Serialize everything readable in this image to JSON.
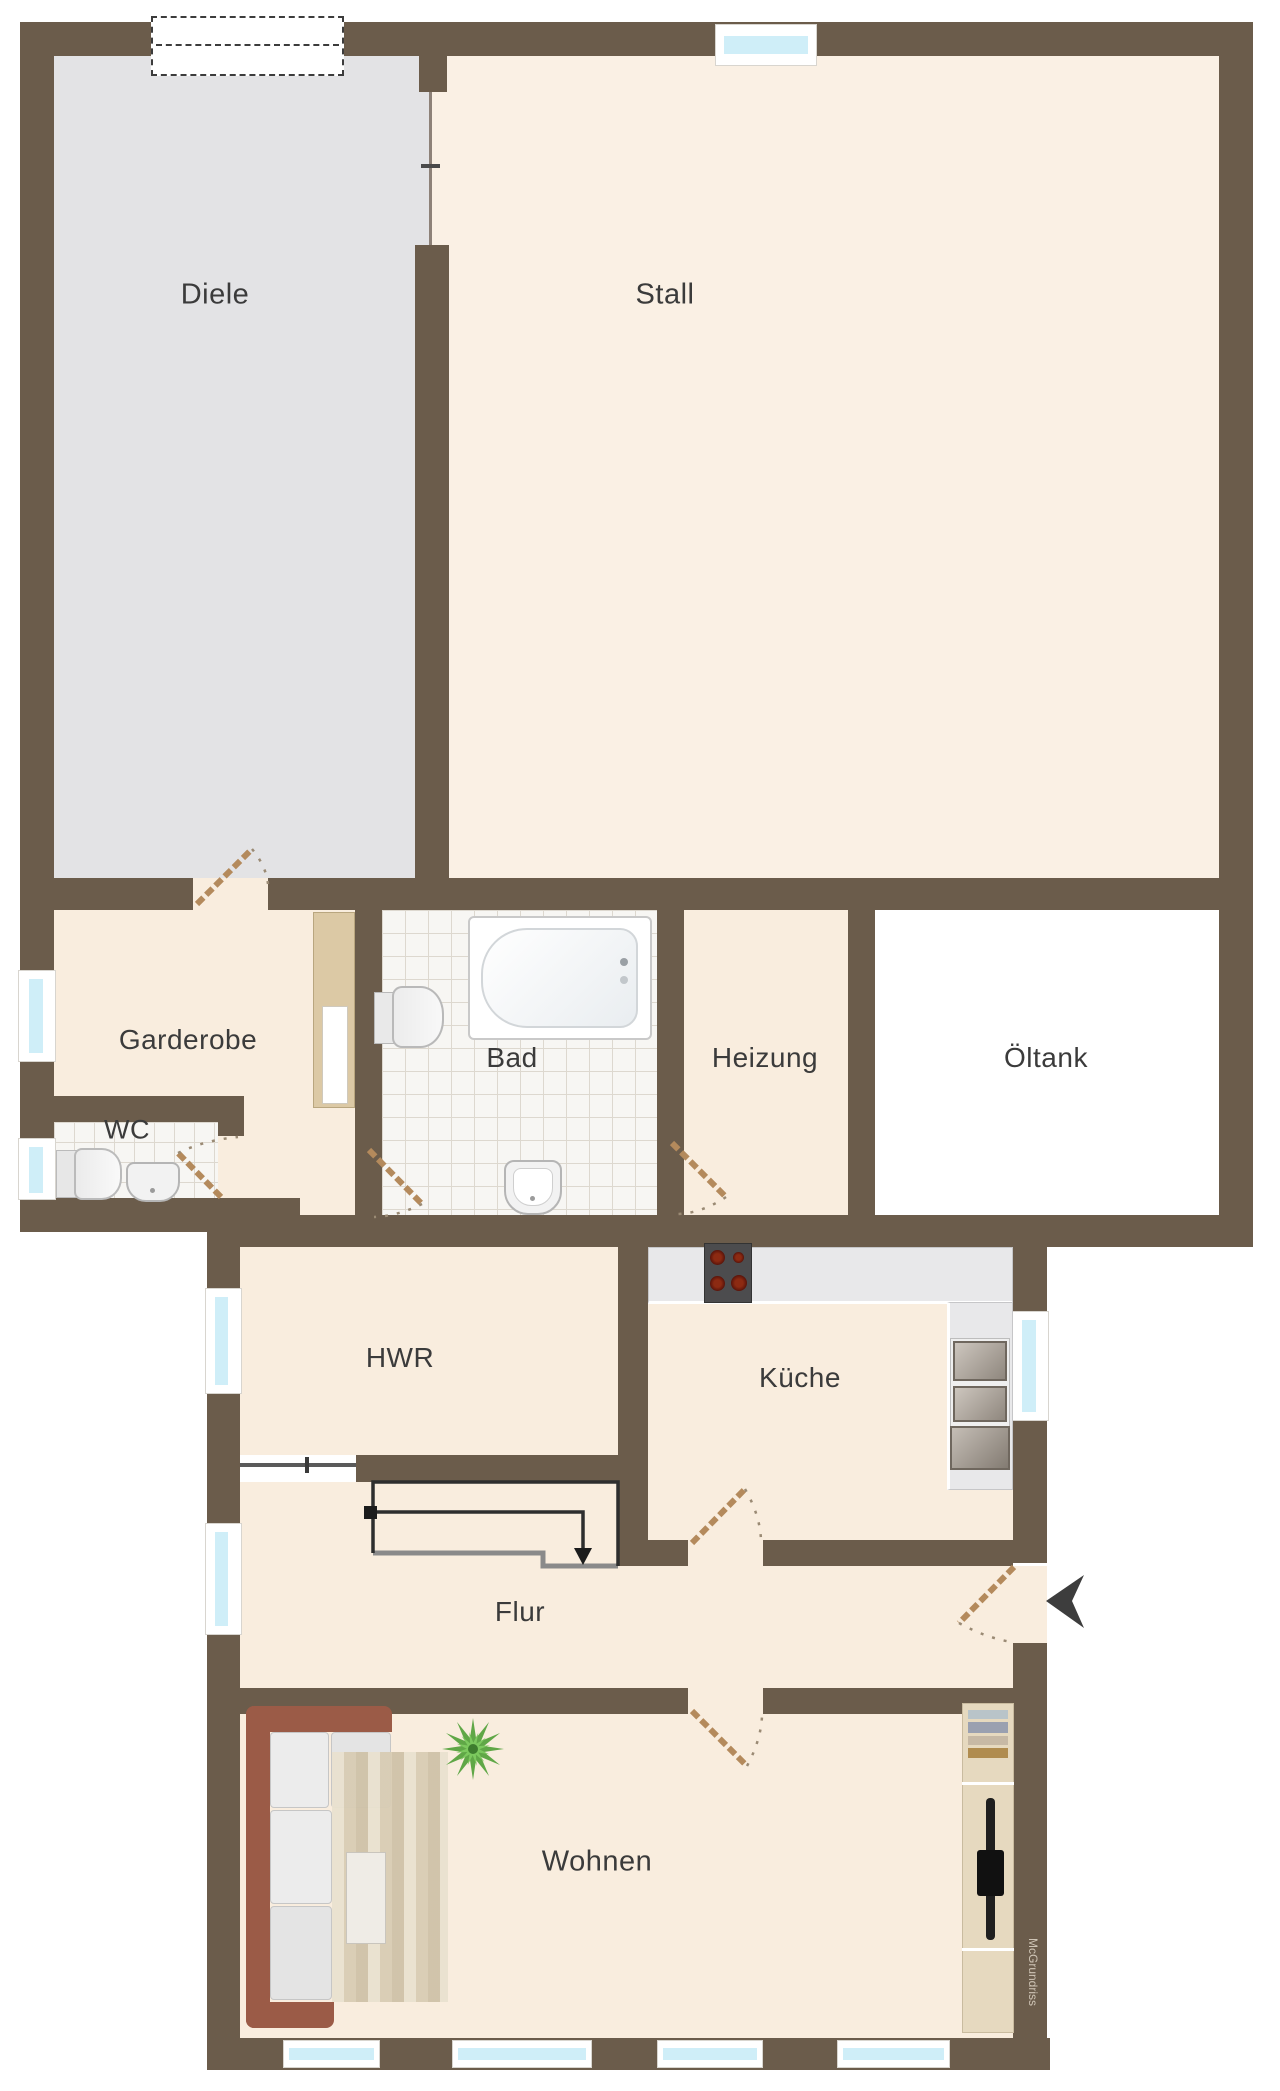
{
  "meta": {
    "type": "floorplan",
    "language": "de"
  },
  "rooms": {
    "diele": {
      "label": "Diele"
    },
    "stall": {
      "label": "Stall"
    },
    "garderobe": {
      "label": "Garderobe"
    },
    "wc": {
      "label": "WC"
    },
    "bad": {
      "label": "Bad"
    },
    "heizung": {
      "label": "Heizung"
    },
    "oeltank": {
      "label": "Öltank"
    },
    "hwr": {
      "label": "HWR"
    },
    "kueche": {
      "label": "Küche"
    },
    "flur": {
      "label": "Flur"
    },
    "wohnen": {
      "label": "Wohnen"
    }
  },
  "branding": {
    "watermark": "McGrundriss"
  },
  "colors": {
    "wall": "#6b5c4b",
    "floor_cream": "#f9edde",
    "floor_stall": "#faf0e4",
    "floor_diele": "#e3e3e5",
    "floor_oeltank": "#ffffff",
    "window_glass": "#cfeef8",
    "door_leaf": "#b48a5c",
    "stairs": "#2e2e2e"
  }
}
